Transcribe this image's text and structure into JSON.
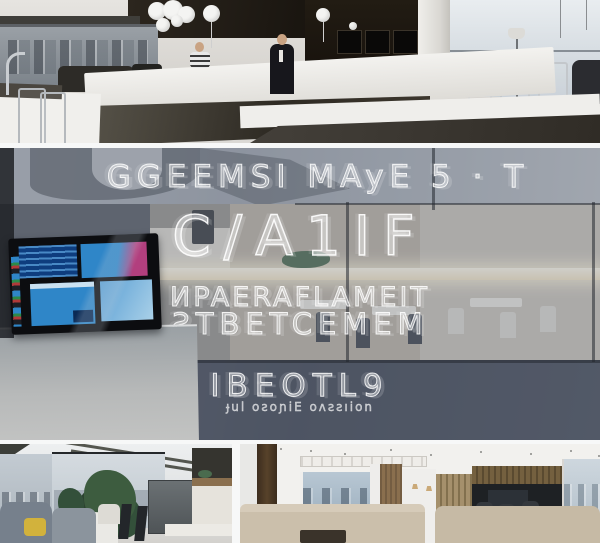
{
  "overlay_text": {
    "line1": "GGEEMSI MAyE 5 · T",
    "line2": "C/A1IF",
    "line3": "ИPAERAFLAMEIT",
    "line4": "ƧTBETCEMEM",
    "line5": "IBEOTL9",
    "line6": "ɟul oƨoɲiE oʌƨƨıion"
  },
  "colors": {
    "divider_white": "#f7f8f8",
    "glass_tint": "#828b9a",
    "glass_dark_band": "#4d5464",
    "light_strip": "#f4e4c3",
    "screen_blue_dark": "#0e3d7e",
    "screen_blue": "#2f86c8",
    "screen_magenta": "#b23f7e",
    "balloon_white": "#f4f4f2",
    "pillow_yellow": "#d2b23c",
    "wood_warm": "#8a6f4e",
    "plant_green": "#3d5c3f",
    "ceiling_dark": "#221c15",
    "counter_gray": "#a8acae"
  }
}
